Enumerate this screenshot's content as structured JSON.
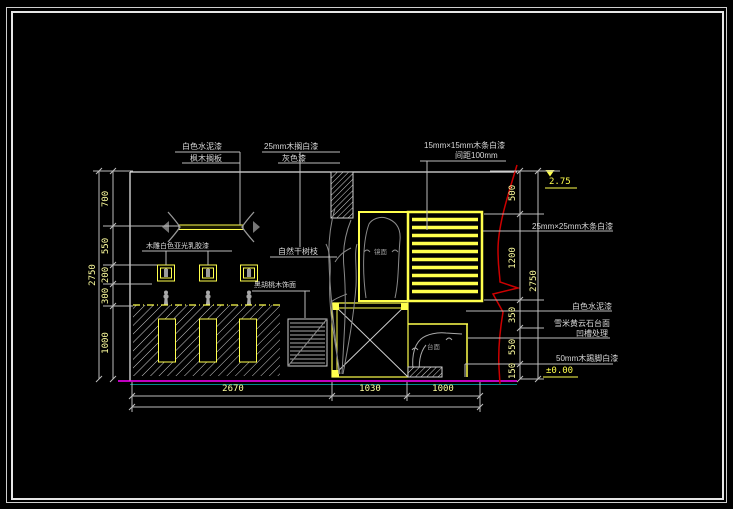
{
  "drawing": {
    "type": "interior-elevation-cad",
    "colors": {
      "line_yellow": "#ffff4d",
      "dim_text_yellow": "#ffff9e",
      "floor_magenta": "#ff00ff",
      "floor_cyan": "#009090",
      "break_line_red": "#cc0000",
      "line_white": "#e0e0e0",
      "detail_gray": "#909090"
    }
  },
  "labels": {
    "top_left_1": "白色水泥漆",
    "top_left_2": "枫木搁板",
    "top_mid_1": "25mm木搁白漆",
    "top_mid_2": "灰色漆",
    "top_right_1": "15mm×15mm木条白漆",
    "top_right_2": "间距100mm",
    "right_strips": "25mm×25mm木条白漆",
    "right_wall": "白色水泥漆",
    "right_marble_1": "雪米黄云石台面",
    "right_marble_2": "凹槽处理",
    "right_skirting": "50mm木踢脚白漆",
    "carving": "木雕白色亚光乳胶漆",
    "branches": "自然干树枝",
    "louver_cabinet": "黑胡桃木饰面",
    "mirror_tiny": "镜面",
    "counter_tiny": "台面",
    "level_top": "2.75",
    "level_bottom": "±0.00"
  },
  "dims": {
    "left_overall": "2750",
    "left_chain": [
      "700",
      "550",
      "200",
      "300",
      "1000"
    ],
    "right_chain": [
      "500",
      "1200",
      "350",
      "550",
      "150"
    ],
    "right_overall": "2750",
    "bottom_chain": [
      "2670",
      "1030",
      "1000"
    ]
  }
}
